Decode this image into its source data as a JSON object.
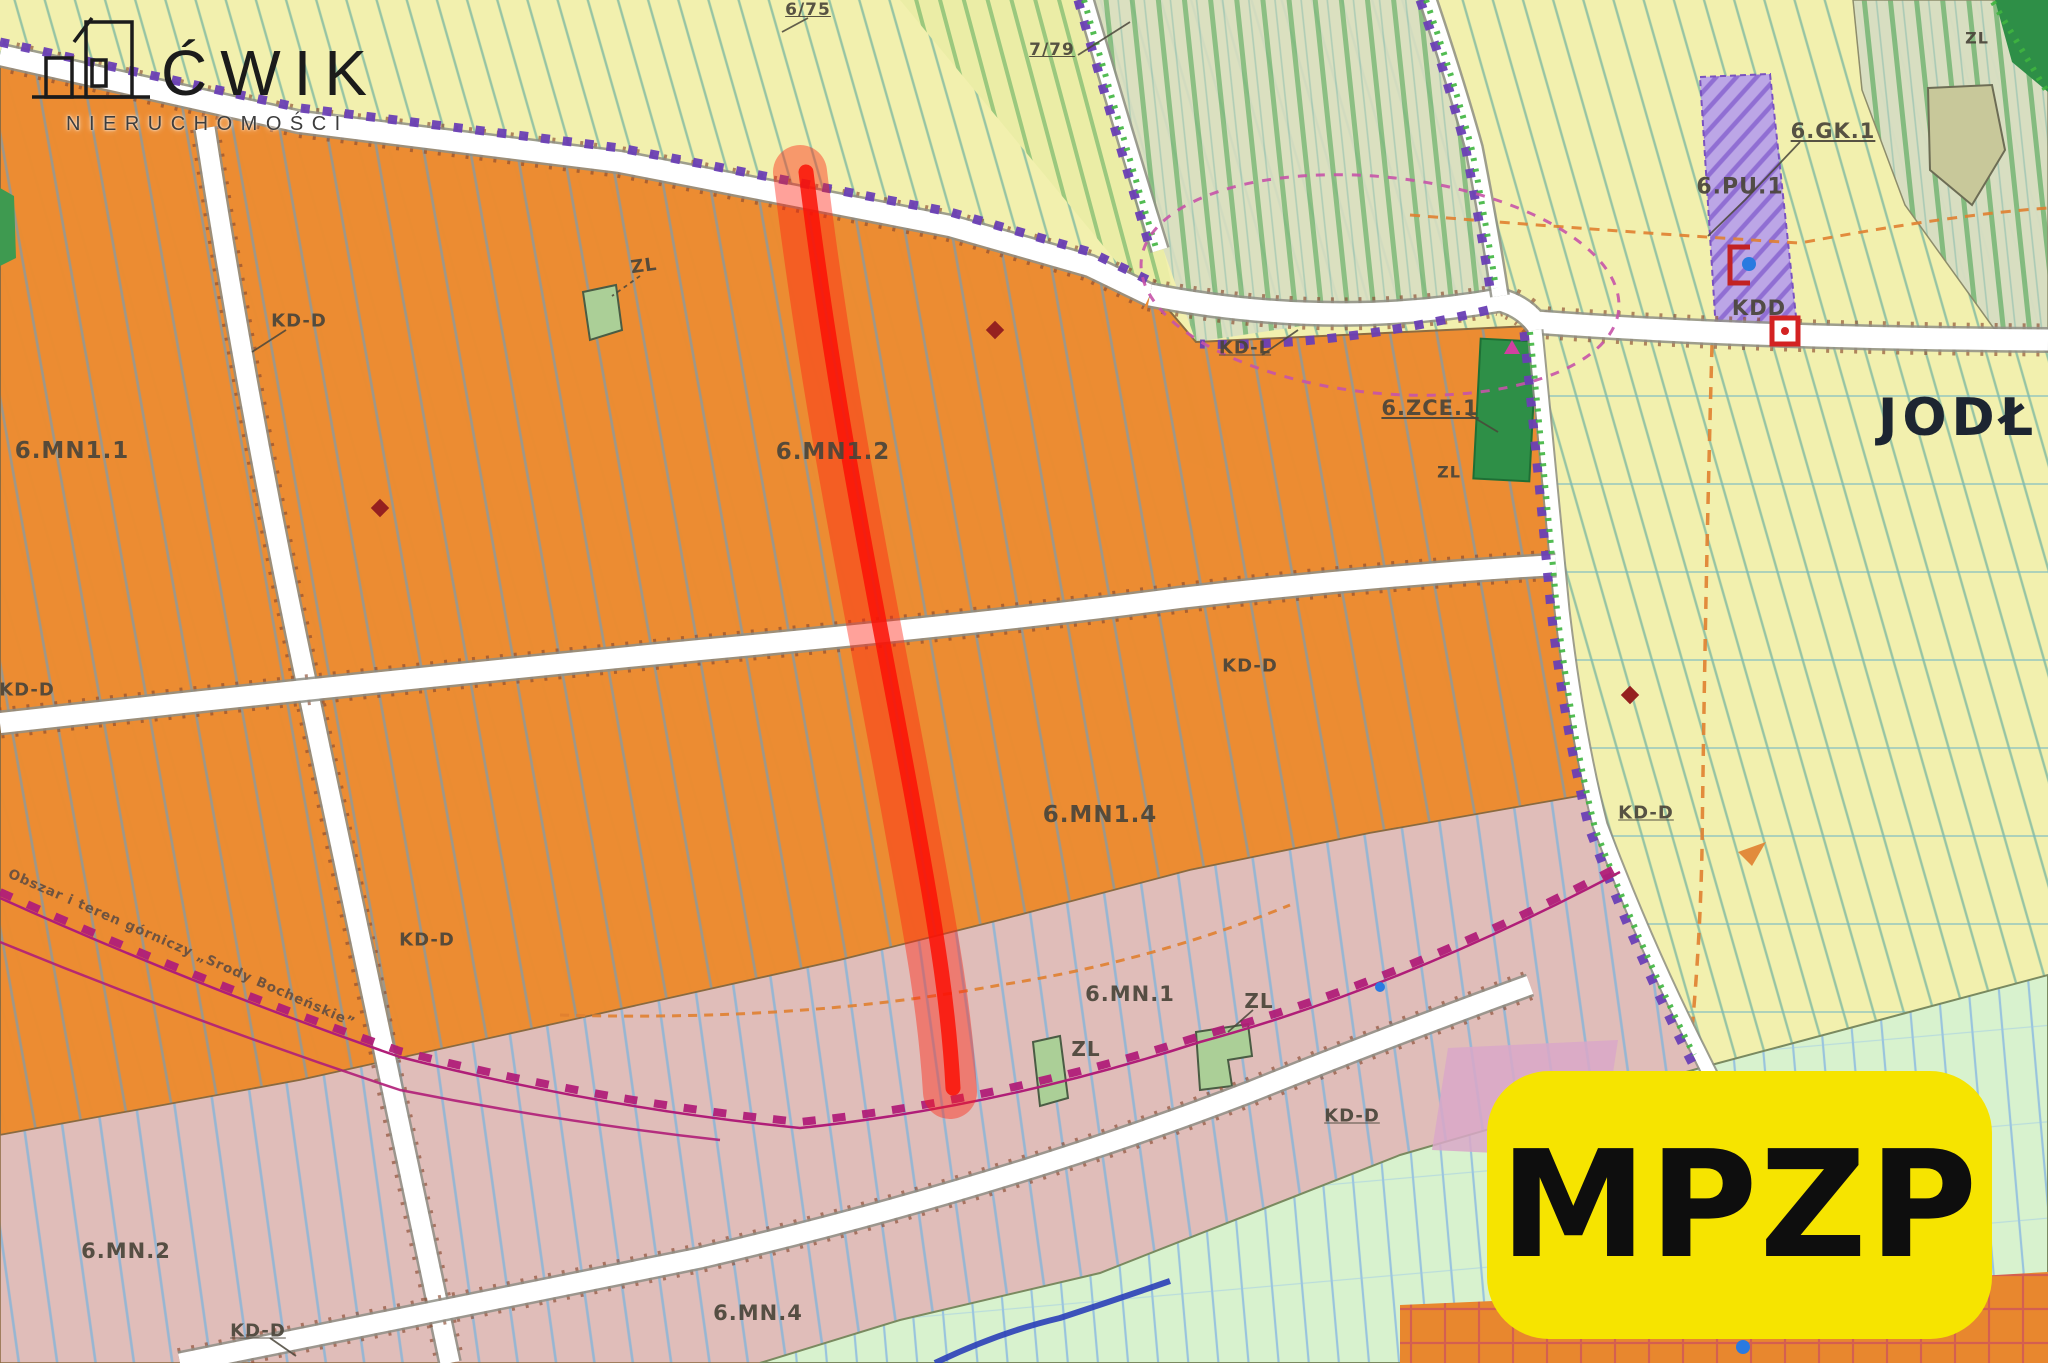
{
  "colors": {
    "zone_orange": "#EC8B30",
    "zone_pink": "#E0BDB9",
    "zone_yellow": "#F2F0AE",
    "zone_sage": "#D8DEC2",
    "zone_mint": "#D8F2CE",
    "zone_purple": "#BCA6E6",
    "forest_green": "#2E8F47",
    "patch_green": "#ABCF97",
    "highlight_red": "#FF2012",
    "badge_yellow": "#F6E400",
    "badge_text": "#0E0E0E",
    "boundary_purple": "#6A3FB5",
    "zigzag_magenta": "#B01E78",
    "road_white": "#FFFFFF",
    "label_ink": "#4A453A",
    "place_ink": "#1D2531",
    "river_blue": "#2B3FB8",
    "orange_dash": "#E08030",
    "logo_ink": "#1B1B1B"
  },
  "branding": {
    "logo_name": "ĆWIK",
    "logo_subtitle": "NIERUCHOMOŚCI",
    "badge_label": "MPZP"
  },
  "labels": {
    "parcel_6_75": "6/75",
    "parcel_7_79": "7/79",
    "zl_top_right": "ZL",
    "gk_1": "6.GK.1",
    "pu_1": "6.PU.1",
    "kdd": "KDD",
    "kd_l": "KD-L",
    "zce_1": "6.ZCE.1",
    "zl_zce": "ZL",
    "place_name": "JODŁ",
    "kd_d_top": "KD-D",
    "mn1_1": "6.MN1.1",
    "mn1_2": "6.MN1.2",
    "kd_d_left": "KD-D",
    "kd_d_mid": "KD-D",
    "mn1_4": "6.MN1.4",
    "kd_d_road": "KD-D",
    "kd_d_right": "KD-D",
    "mn_1": "6.MN.1",
    "zl_right_patch": "ZL",
    "zl_left_patch": "ZL",
    "kd_d_south": "KD-D",
    "mn_2": "6.MN.2",
    "kd_d_bottom": "KD-D",
    "mn_4": "6.MN.4",
    "zl_orange_patch": "ZL",
    "mining_note": "Obszar i teren górniczy „Srody Bocheńskie”"
  }
}
